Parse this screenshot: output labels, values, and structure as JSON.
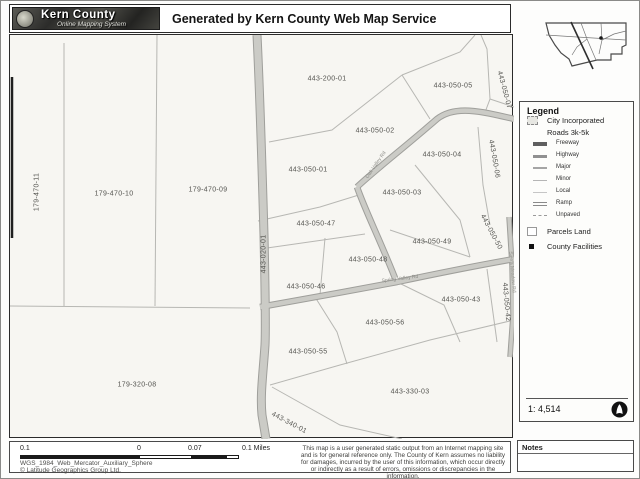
{
  "header": {
    "logo_title": "Kern County",
    "logo_subtitle": "Online Mapping System",
    "title": "Generated by Kern County Web Map Service"
  },
  "legend": {
    "title": "Legend",
    "items": [
      {
        "label": "City Incorporated",
        "type": "city"
      },
      {
        "label": "Roads 3k-5k",
        "type": "group"
      },
      {
        "label": "Freeway",
        "type": "line",
        "weight": 4,
        "color": "#5f5f5f"
      },
      {
        "label": "Highway",
        "type": "line",
        "weight": 3,
        "color": "#909090"
      },
      {
        "label": "Major",
        "type": "line",
        "weight": 2,
        "color": "#a5a5a5"
      },
      {
        "label": "Minor",
        "type": "line",
        "weight": 1,
        "color": "#b5b5b5"
      },
      {
        "label": "Local",
        "type": "line",
        "weight": 1,
        "color": "#c6c6c6"
      },
      {
        "label": "Ramp",
        "type": "ramp",
        "color": "#8a8a8a"
      },
      {
        "label": "Unpaved",
        "type": "dashed",
        "color": "#9a9a9a"
      },
      {
        "label": "Parcels Land",
        "type": "parcel"
      },
      {
        "label": "County Facilities",
        "type": "facility"
      }
    ],
    "scale_ratio": "1: 4,514"
  },
  "map": {
    "parcel_labels": [
      {
        "text": "179-470-11",
        "x": 27,
        "y": 157,
        "rot": -90
      },
      {
        "text": "179-470-10",
        "x": 104,
        "y": 159,
        "rot": 0
      },
      {
        "text": "179-470-09",
        "x": 198,
        "y": 155,
        "rot": 0
      },
      {
        "text": "179-320-08",
        "x": 127,
        "y": 350,
        "rot": 0
      },
      {
        "text": "443-200-01",
        "x": 317,
        "y": 44,
        "rot": 0
      },
      {
        "text": "443-050-05",
        "x": 443,
        "y": 51,
        "rot": 0
      },
      {
        "text": "443-050-07",
        "x": 494,
        "y": 55,
        "rot": 75
      },
      {
        "text": "443-050-02",
        "x": 365,
        "y": 96,
        "rot": 0
      },
      {
        "text": "443-050-04",
        "x": 432,
        "y": 120,
        "rot": 0
      },
      {
        "text": "443-050-06",
        "x": 484,
        "y": 124,
        "rot": 80
      },
      {
        "text": "443-050-01",
        "x": 298,
        "y": 135,
        "rot": 0
      },
      {
        "text": "443-050-03",
        "x": 392,
        "y": 158,
        "rot": 0
      },
      {
        "text": "443-050-47",
        "x": 306,
        "y": 189,
        "rot": 0
      },
      {
        "text": "443-050-49",
        "x": 422,
        "y": 207,
        "rot": 0
      },
      {
        "text": "443-050-50",
        "x": 481,
        "y": 197,
        "rot": 62
      },
      {
        "text": "443-050-48",
        "x": 358,
        "y": 225,
        "rot": 0
      },
      {
        "text": "443-050-46",
        "x": 296,
        "y": 252,
        "rot": 0
      },
      {
        "text": "443-050-43",
        "x": 451,
        "y": 265,
        "rot": 0
      },
      {
        "text": "443-050-42",
        "x": 496,
        "y": 267,
        "rot": 85
      },
      {
        "text": "443-050-56",
        "x": 375,
        "y": 288,
        "rot": 0
      },
      {
        "text": "443-050-55",
        "x": 298,
        "y": 317,
        "rot": 0
      },
      {
        "text": "443-330-03",
        "x": 400,
        "y": 357,
        "rot": 0
      },
      {
        "text": "443-340-01",
        "x": 279,
        "y": 388,
        "rot": 28
      },
      {
        "text": "443-020-01",
        "x": 254,
        "y": 219,
        "rot": -90
      }
    ],
    "road_labels": [
      {
        "text": "Oak Valley Rd",
        "x": 366,
        "y": 130,
        "rot": -55
      },
      {
        "text": "Spring Valley Rd",
        "x": 390,
        "y": 244,
        "rot": -7
      },
      {
        "text": "Sierra Meadow Rd",
        "x": 502,
        "y": 237,
        "rot": 85
      }
    ]
  },
  "footer": {
    "scale_labels": [
      "0.1",
      "0",
      "0.07",
      "0.1 Miles"
    ],
    "projection": "WGS_1984_Web_Mercator_Auxiliary_Sphere",
    "copyright": "© Latitude Geographics Group Ltd.",
    "disclaimer": "This map is a user generated static output from an Internet mapping site and is for general reference only.  The County of Kern assumes no liability for damages, incurred by the user of this information, which occur directly or indirectly as a result of errors, omissions or discrepancies in the information.",
    "notes_title": "Notes"
  }
}
